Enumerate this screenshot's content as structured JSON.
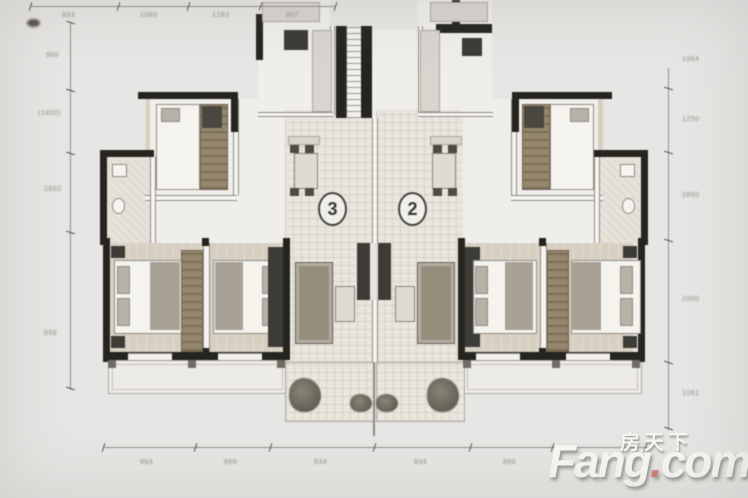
{
  "units": {
    "left_label": "3",
    "right_label": "2"
  },
  "watermark": {
    "cn": "房天下",
    "fang": "Fang",
    "dot": ".",
    "com": "com"
  },
  "dimensions": {
    "top": [
      "893",
      "1060",
      "1283",
      "907"
    ],
    "left": [
      "950",
      "(1450)",
      "2850",
      "858"
    ],
    "right": [
      "1064",
      "1250",
      "2850",
      "2000",
      "1061"
    ],
    "bottom": [
      "863",
      "888",
      "934",
      "934",
      "888",
      "863"
    ]
  },
  "colors": {
    "background": "#e8e6e4",
    "wall": "#26241f",
    "wood": "#95876d",
    "logo_dot": "#c2695c"
  }
}
